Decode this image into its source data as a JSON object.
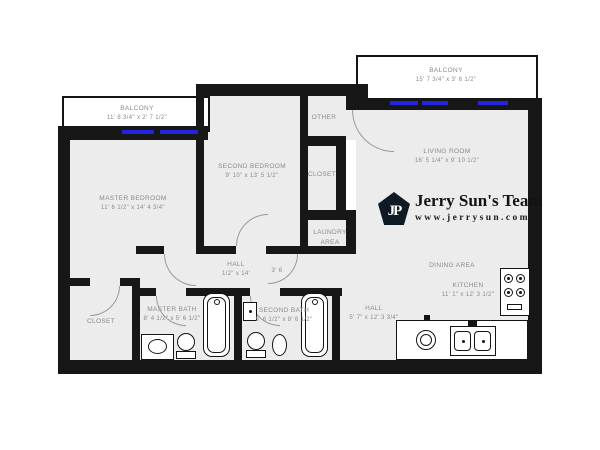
{
  "rooms": {
    "balcony_left": {
      "name": "BALCONY",
      "dims": "11' 8 3/4\" x 2' 7 1/2\""
    },
    "balcony_right": {
      "name": "BALCONY",
      "dims": "15' 7 3/4\" x 3' 6 1/2\""
    },
    "master_bedroom": {
      "name": "MASTER BEDROOM",
      "dims": "11' 6 1/2\" x 14' 4 3/4\""
    },
    "second_bedroom": {
      "name": "SECOND BEDROOM",
      "dims": "9' 10\" x 13' 5 1/2\""
    },
    "living_room": {
      "name": "LIVING ROOM",
      "dims": "16' 5 1/4\" x 9' 10 1/2\""
    },
    "other": {
      "name": "OTHER"
    },
    "closet_middle": {
      "name": "CLOSET"
    },
    "laundry_area": {
      "name": "LAUNDRY AREA"
    },
    "hall_middle": {
      "name": "HALL",
      "dims": "1/2\" x 14'",
      "door_note": "3' 6"
    },
    "master_bath": {
      "name": "MASTER BATH",
      "dims": "8' 4 1/2\" x 5' 6 1/2\""
    },
    "second_bath": {
      "name": "SECOND BATH",
      "dims": "5' 6 1/2\" x 8' 6 1/2\""
    },
    "hall_lower": {
      "name": "HALL",
      "dims": "5' 7\" x 12' 3 3/4\""
    },
    "dining_area": {
      "name": "DINING AREA"
    },
    "kitchen": {
      "name": "KITCHEN",
      "dims": "11' 1\" x 12' 3 1/2\""
    },
    "closet_lower_left": {
      "name": "CLOSET"
    }
  },
  "branding": {
    "monogram": "JP",
    "team_name": "Jerry Sun's Team",
    "website": "www.jerrysun.com"
  },
  "colors": {
    "wall": "#171717",
    "floor": "#ececec",
    "window_blue": "#2424e0",
    "logo_dark": "#101a24",
    "label_gray": "#8a8a8a"
  }
}
